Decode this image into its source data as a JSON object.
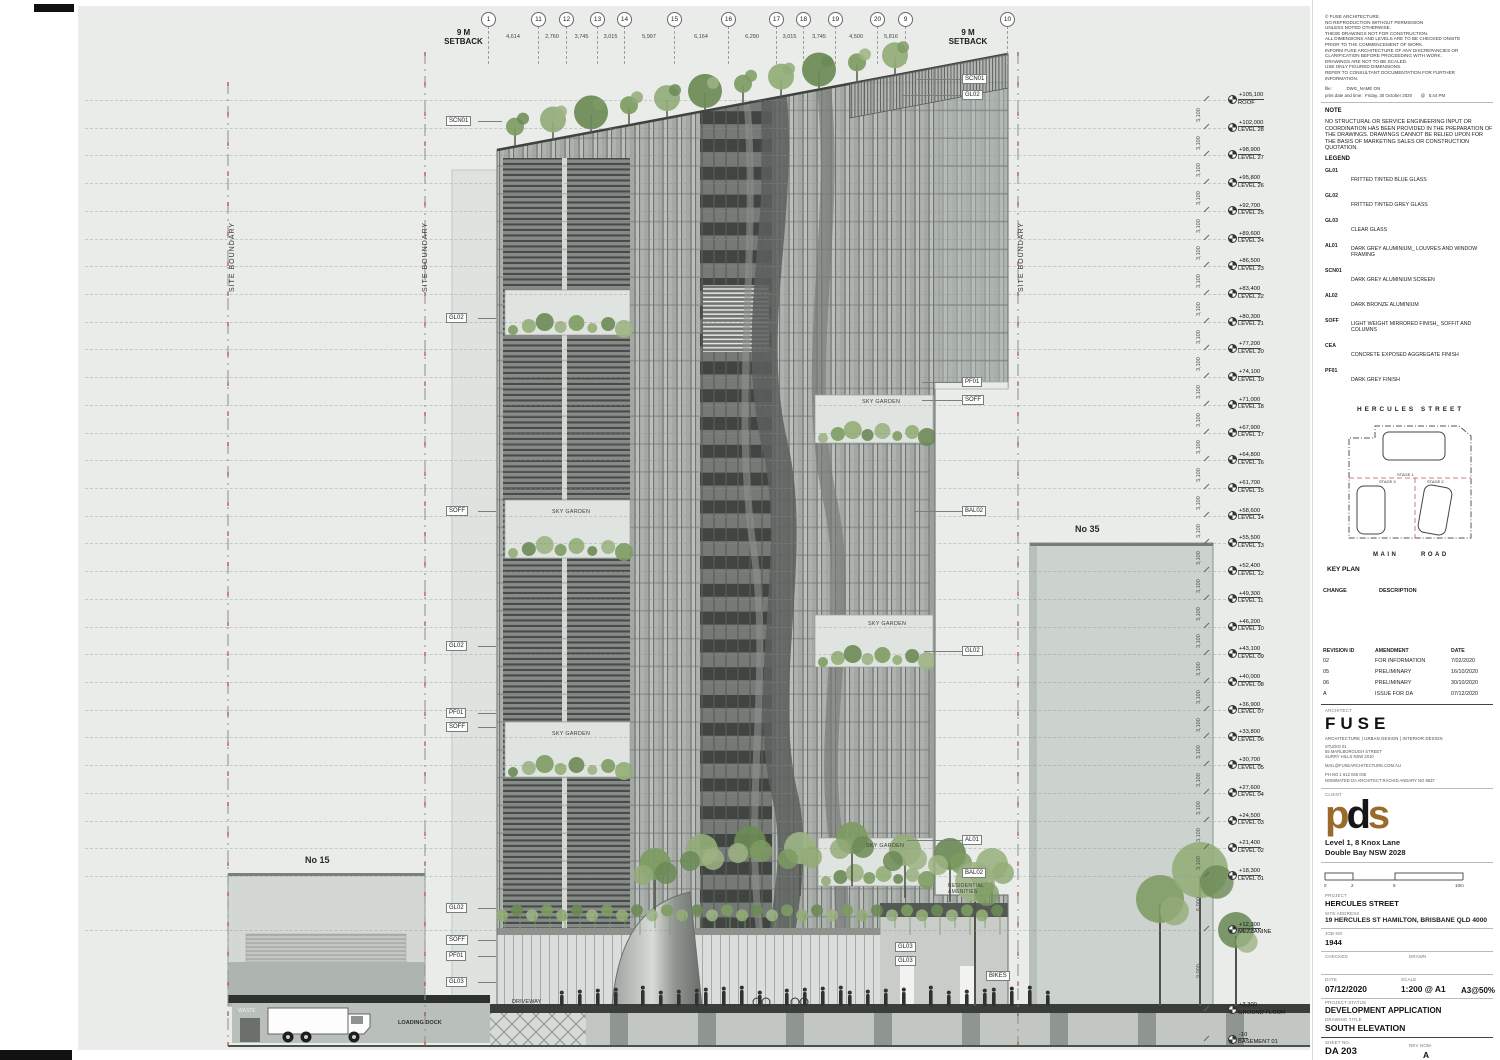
{
  "colors": {
    "background": "#e9ece9",
    "boundary_red": "#b3392f",
    "vegetation": "#7d9b62",
    "facade_dark": "#555957",
    "facade_mid": "#9ba09d",
    "facade_light": "#c8ccc9",
    "pds_brown": "#9a6a2b",
    "ground_dark": "#35393 6"
  },
  "notes_panel": {
    "general_notes": [
      "© FUSE ARCHITECTURE.",
      "NO REPRODUCTION WITHOUT PERMISSION",
      "UNLESS NOTED OTHERWISE.",
      "THESE DRAWINGS NOT FOR CONSTRUCTION.",
      "ALL DIMENSIONS AND LEVELS ARE TO BE CHECKED ONSITE",
      "PRIOR TO THE COMMENCEMENT OF WORK.",
      "INFORM FUSE ARCHITECTURE OF ANY DISCREPANCIES OR",
      "CLARIFICATION BEFORE PROCEEDING WITH WORK.",
      "DRAWINGS ARE NOT TO BE SCALED.",
      "USE ONLY FIGURED DIMENSIONS.",
      "REFER TO CONSULTANT DOCUMENTATION FOR FURTHER",
      "INFORMATION."
    ],
    "file_label": "file:",
    "file_value": "DWG_NAME ON",
    "print_label": "print date and time:",
    "print_value": "Friday, 30 October 2020",
    "print_at": "@",
    "print_time": "5:44 PM",
    "note_title": "NOTE",
    "note_body": "NO STRUCTURAL OR SERVICE ENGINEERING INPUT OR COORDINATION HAS BEEN PROVIDED IN THE PREPARATION OF THE DRAWINGS. DRAWINGS CANNOT BE RELIED UPON FOR THE BASIS OF MARKETING SALES OR CONSTRUCTION QUOTATION.",
    "legend_title": "LEGEND",
    "legend": [
      {
        "code": "GL01",
        "desc": "FRITTED TINTED BLUE GLASS"
      },
      {
        "code": "GL02",
        "desc": "FRITTED TINTED GREY GLASS"
      },
      {
        "code": "GL03",
        "desc": "CLEAR GLASS"
      },
      {
        "code": "AL01",
        "desc": "DARK GREY ALUMINIUM_ LOUVRES AND WINDOW FRAMING"
      },
      {
        "code": "SCN01",
        "desc": "DARK GREY ALUMINIUM SCREEN"
      },
      {
        "code": "AL02",
        "desc": "DARK BRONZE ALUMINIUM"
      },
      {
        "code": "SOFF",
        "desc": "LIGHT WEIGHT MIRRORED FINISH_ SOFFIT AND COLUMNS"
      },
      {
        "code": "CEA",
        "desc": "CONCRETE EXPOSED AGGREGATE FINISH"
      },
      {
        "code": "PF01",
        "desc": "DARK GREY FINISH"
      }
    ]
  },
  "key_plan": {
    "street_top": "HERCULES STREET",
    "road_left": "MAIN",
    "road_right": "ROAD",
    "title": "KEY PLAN",
    "stages": [
      "STAGE 1",
      "STAGE 3",
      "STAGE 2"
    ],
    "change_label": "CHANGE",
    "description_label": "DESCRIPTION"
  },
  "revisions": {
    "headers": [
      "REVISION ID",
      "AMENDMENT",
      "DATE"
    ],
    "rows": [
      [
        "02",
        "FOR INFORMATION",
        "7/02/2020"
      ],
      [
        "05",
        "PRELIMINARY",
        "16/10/2020"
      ],
      [
        "06",
        "PRELIMINARY",
        "30/10/2020"
      ],
      [
        "A",
        "ISSUE FOR DA",
        "07/12/2020"
      ]
    ]
  },
  "architect": {
    "label": "ARCHITECT",
    "name": "FUSE",
    "tagline": "ARCHITECTURE |  URBAN DESIGN  | INTERIOR DESIGN",
    "address": [
      "STUDIO 01",
      "55 MARLBOROUGH STREET",
      "SURRY HILLS NSW 2010"
    ],
    "email": "MAIL@FUSEARCHITECTURE.COM.AU",
    "phone": "PH NO 1 612 045 045",
    "nominated": "NOMINATED DA ARCHITECT  RACHID ANDARY NO 8637"
  },
  "client": {
    "label": "CLIENT",
    "logo_p": "p",
    "logo_d": "d",
    "logo_s": "s",
    "address": [
      "Level 1, 8 Knox Lane",
      "Double Bay NSW 2028"
    ]
  },
  "scale_bar": {
    "ticks": [
      "0",
      "2",
      "5",
      "10m"
    ]
  },
  "project": {
    "project_label": "PROJECT",
    "project": "HERCULES STREET",
    "site_label": "SITE ADDRESS",
    "site": "19 HERCULES ST HAMILTON, BRISBANE  QLD 4000",
    "job_label": "JOB NO",
    "job": "1944",
    "checked_label": "CHECKED",
    "drawn_label": "DRAWN",
    "date_label": "DATE",
    "date": "07/12/2020",
    "scale_label": "SCALE",
    "scale": "1:200 @ A1",
    "scale2": "A3@50%",
    "status_label": "PROJECT STATUS",
    "status": "DEVELOPMENT APPLICATION",
    "title_label": "DRAWING TITLE",
    "title": "SOUTH ELEVATION",
    "sheet_label": "SHEET NO.",
    "sheet": "DA 203",
    "rev_label": "REV NOM.",
    "rev": "A"
  },
  "drawing": {
    "setback_line1": "9 M",
    "setback_line2": "SETBACK",
    "site_boundary": "SITE BOUNDARY",
    "grids": [
      {
        "label": "1",
        "dim_to_next": "4,614"
      },
      {
        "label": "11",
        "dim_to_next": "2,760"
      },
      {
        "label": "12",
        "dim_to_next": "3,745"
      },
      {
        "label": "13",
        "dim_to_next": "3,015"
      },
      {
        "label": "14",
        "dim_to_next": "5,997"
      },
      {
        "label": "15",
        "dim_to_next": "6,164"
      },
      {
        "label": "16",
        "dim_to_next": "6,290"
      },
      {
        "label": "17",
        "dim_to_next": "3,015"
      },
      {
        "label": "18",
        "dim_to_next": "3,745"
      },
      {
        "label": "19",
        "dim_to_next": "4,500"
      },
      {
        "label": "20",
        "dim_to_next": "5,816"
      },
      {
        "label": "9",
        "dim_to_next": ""
      },
      {
        "label": "10",
        "dim_to_next": ""
      }
    ],
    "levels": [
      {
        "rl": "+105,100",
        "name": "ROOF"
      },
      {
        "rl": "+102,000",
        "name": "LEVEL 28"
      },
      {
        "rl": "+98,900",
        "name": "LEVEL 27"
      },
      {
        "rl": "+95,800",
        "name": "LEVEL 26"
      },
      {
        "rl": "+92,700",
        "name": "LEVEL 25"
      },
      {
        "rl": "+89,600",
        "name": "LEVEL 24"
      },
      {
        "rl": "+86,500",
        "name": "LEVEL 23"
      },
      {
        "rl": "+83,400",
        "name": "LEVEL 22"
      },
      {
        "rl": "+80,300",
        "name": "LEVEL 21"
      },
      {
        "rl": "+77,200",
        "name": "LEVEL 20"
      },
      {
        "rl": "+74,100",
        "name": "LEVEL 19"
      },
      {
        "rl": "+71,000",
        "name": "LEVEL 18"
      },
      {
        "rl": "+67,900",
        "name": "LEVEL 17"
      },
      {
        "rl": "+64,800",
        "name": "LEVEL 16"
      },
      {
        "rl": "+61,700",
        "name": "LEVEL 15"
      },
      {
        "rl": "+58,600",
        "name": "LEVEL 14"
      },
      {
        "rl": "+55,500",
        "name": "LEVEL 13"
      },
      {
        "rl": "+52,400",
        "name": "LEVEL 12"
      },
      {
        "rl": "+49,300",
        "name": "LEVEL 11"
      },
      {
        "rl": "+46,200",
        "name": "LEVEL 10"
      },
      {
        "rl": "+43,100",
        "name": "LEVEL 09"
      },
      {
        "rl": "+40,000",
        "name": "LEVEL 08"
      },
      {
        "rl": "+36,900",
        "name": "LEVEL 07"
      },
      {
        "rl": "+33,800",
        "name": "LEVEL 06"
      },
      {
        "rl": "+30,700",
        "name": "LEVEL 05"
      },
      {
        "rl": "+27,600",
        "name": "LEVEL 04"
      },
      {
        "rl": "+24,500",
        "name": "LEVEL 03"
      },
      {
        "rl": "+21,400",
        "name": "LEVEL 02"
      },
      {
        "rl": "+18,300",
        "name": "LEVEL 01"
      },
      {
        "rl": "+12,300",
        "name": "MEZZANINE"
      },
      {
        "rl": "+3,300",
        "name": "GROUND FLOOR"
      },
      {
        "rl": "-10",
        "name": "BASEMENT 01"
      }
    ],
    "floor_dim": "3,100",
    "dim_l1_mezz": "6,000",
    "dim_mezz_ground": "9,000",
    "labels_left": [
      "SCN01",
      "GL02",
      "SOFF",
      "GL02",
      "PF01",
      "SOFF",
      "GL02",
      "SOFF",
      "PF01",
      "GL03"
    ],
    "labels_right": [
      "SCN01",
      "GL02",
      "PF01",
      "SOFF",
      "BAL02",
      "GL02",
      "AL01",
      "BAL02"
    ],
    "sky_garden": "SKY GARDEN",
    "residential_line1": "RESIDENTIAL",
    "residential_line2": "AMENITIES",
    "neighbors": {
      "left": "No 15",
      "right": "No 35"
    },
    "ground": {
      "waste": "WASTE",
      "loading": "LOADING DOCK",
      "driveway": "DRIVEWAY",
      "gl03a": "GL03",
      "gl03b": "GL03",
      "bikes": "BIKES"
    }
  }
}
